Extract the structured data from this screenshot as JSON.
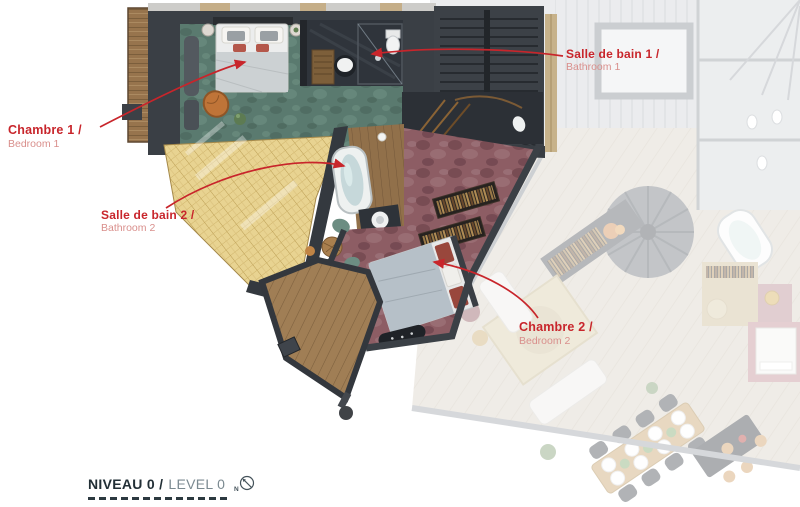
{
  "annotations": {
    "bedroom1": {
      "title": "Chambre 1 /",
      "subtitle": "Bedroom 1"
    },
    "bathroom1": {
      "title": "Salle de bain 1 /",
      "subtitle": "Bathroom 1"
    },
    "bathroom2": {
      "title": "Salle de bain 2 /",
      "subtitle": "Bathroom 2"
    },
    "bedroom2": {
      "title": "Chambre 2 /",
      "subtitle": "Bedroom 2"
    }
  },
  "footer": {
    "level_title": "NIVEAU 0 /",
    "level_subtitle": "LEVEL 0",
    "compass_letter": "N"
  },
  "colors": {
    "annotation_red": "#c8252b",
    "annotation_red_light": "#d98f8c",
    "footer_dark": "#222f36",
    "footer_light": "#7b8a91",
    "teal_carpet": "#5a7a6f",
    "maroon_carpet": "#8d5d64",
    "straw_roof": "#e8d391",
    "wood_deck": "#a07e55",
    "wall_dark": "#3a3f45"
  }
}
